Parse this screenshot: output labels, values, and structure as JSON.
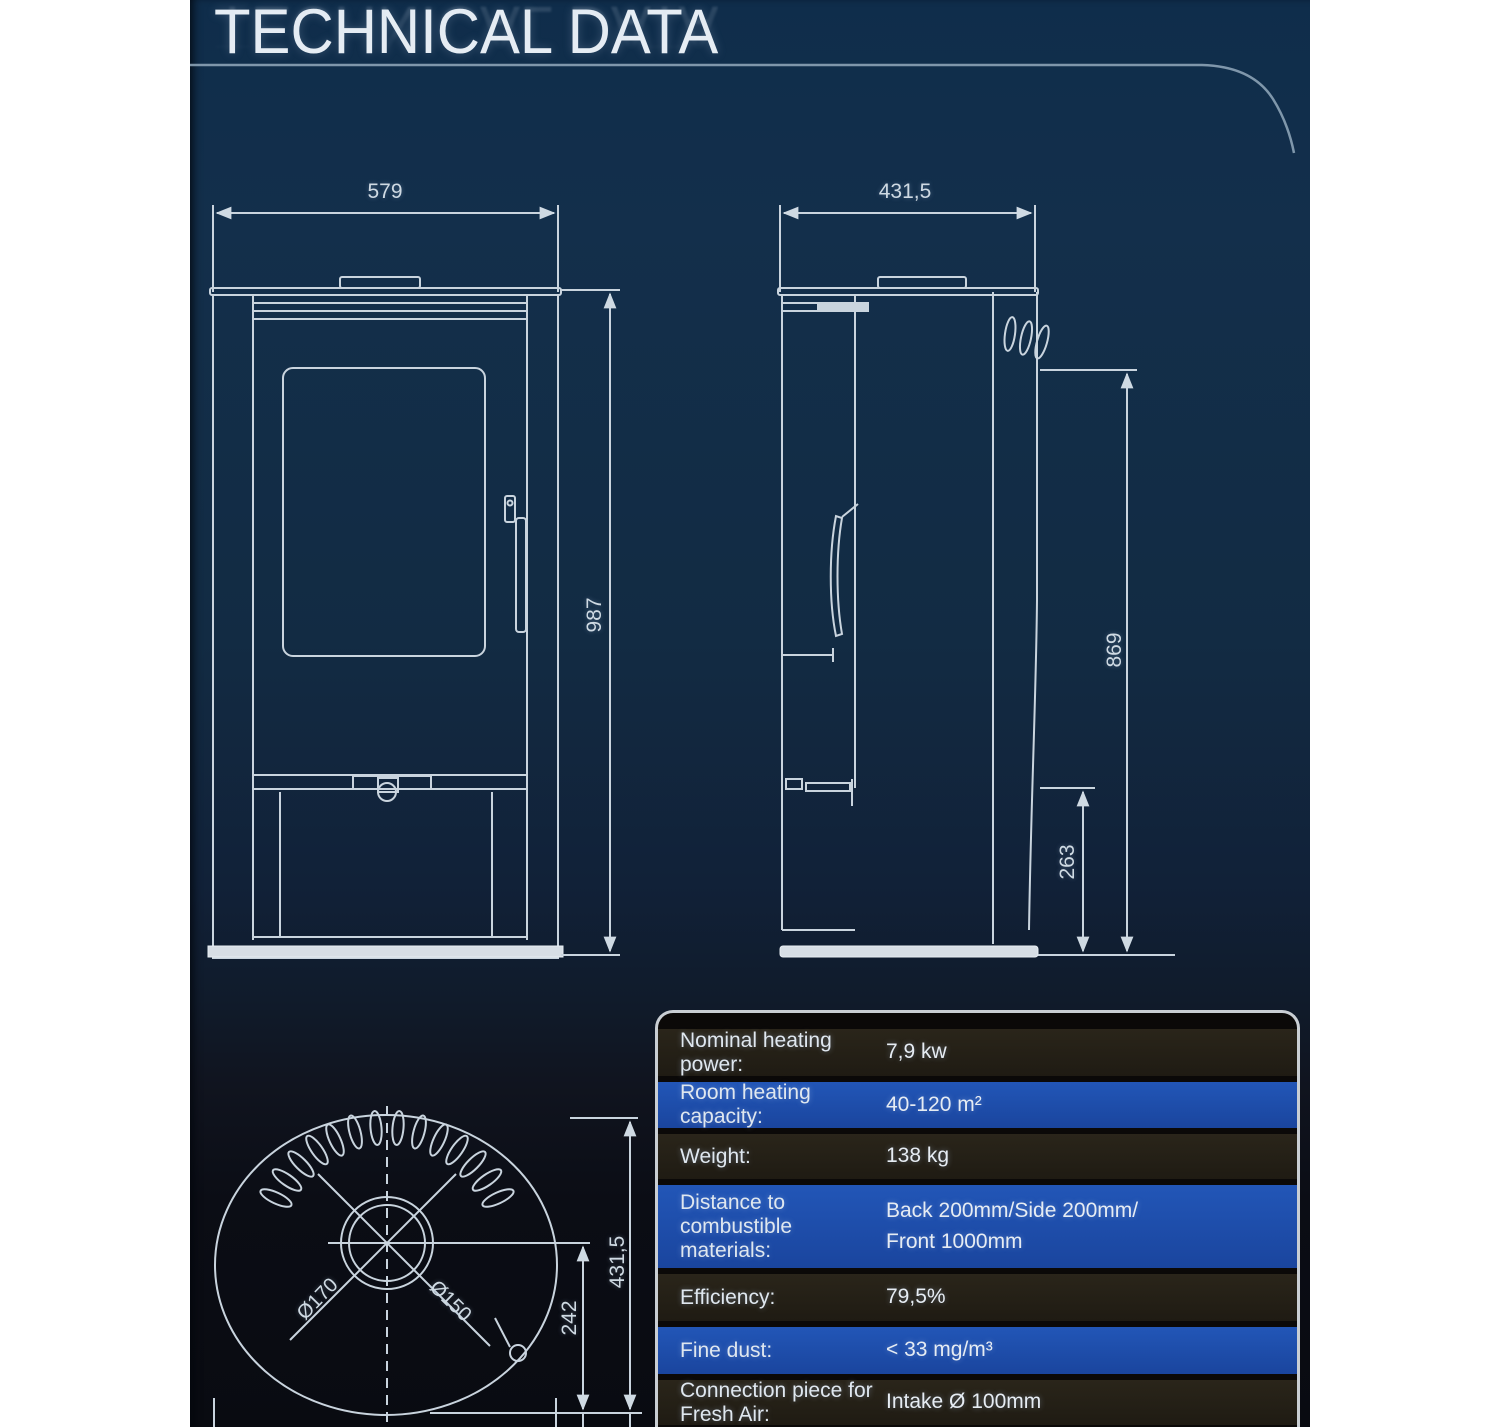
{
  "page": {
    "title": "TECHNICAL DATA"
  },
  "dimensions": {
    "front_width": "579",
    "front_height": "987",
    "side_depth": "431,5",
    "side_rear_height": "869",
    "side_base_height": "263",
    "top_depth": "431,5",
    "top_flue_offset": "242",
    "flue_outer_dia": "Ø170",
    "flue_inner_dia": "Ø150"
  },
  "colors": {
    "accent_blue": "#1e4fae",
    "row_dark": "#242017",
    "panel_navy": "#112b44",
    "line": "#c9d4de"
  },
  "spec_table": {
    "rows": [
      {
        "label": "Nominal heating power:",
        "value": "7,9 kw"
      },
      {
        "label": "Room heating capacity:",
        "value": "40-120 m²"
      },
      {
        "label": "Weight:",
        "value": "138 kg"
      },
      {
        "label": "Distance to combustible materials:",
        "value": "Back 200mm/Side 200mm/\nFront 1000mm"
      },
      {
        "label": "Efficiency:",
        "value": "79,5%"
      },
      {
        "label": "Fine dust:",
        "value": "< 33 mg/m³"
      },
      {
        "label": "Connection piece for Fresh Air:",
        "value": "Intake Ø 100mm"
      }
    ]
  }
}
